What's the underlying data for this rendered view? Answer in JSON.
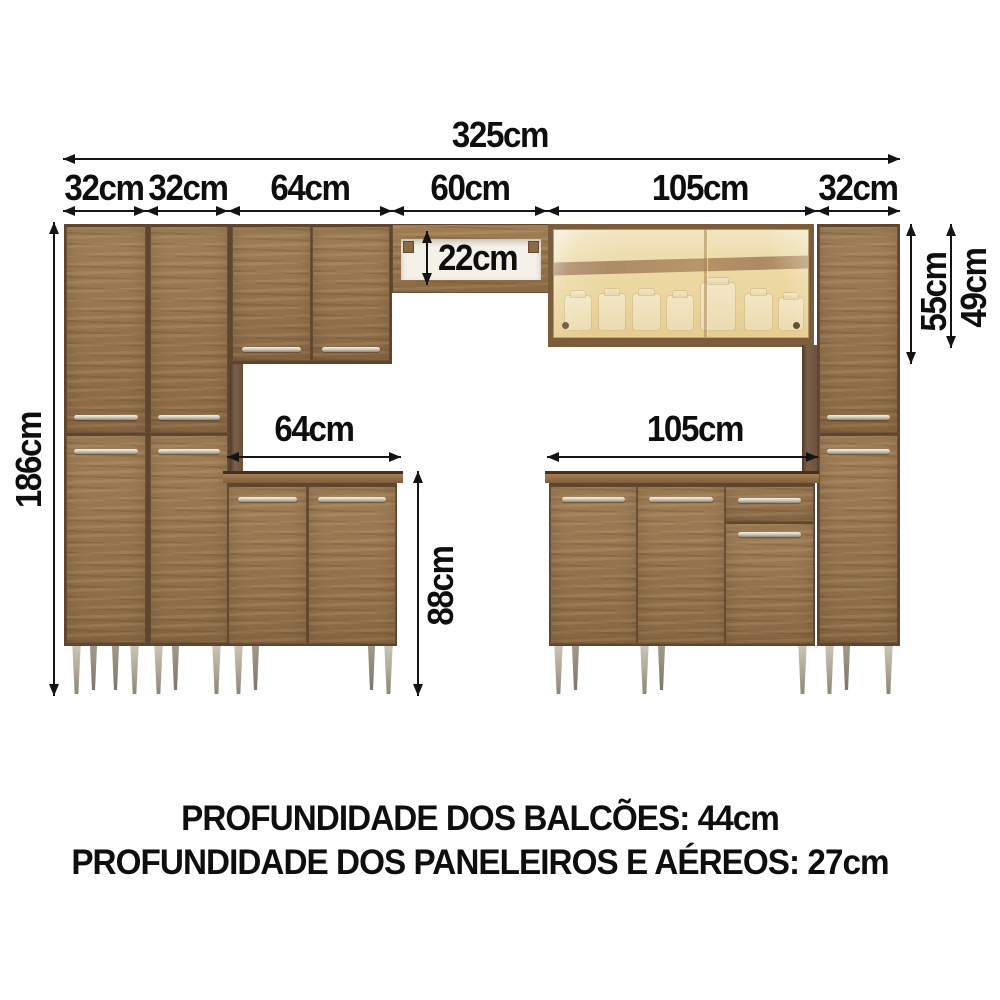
{
  "diagram": {
    "title_none": "",
    "dims": {
      "total_width": "325cm",
      "seg_widths": [
        "32cm",
        "32cm",
        "64cm",
        "60cm",
        "105cm",
        "32cm"
      ],
      "total_height": "186cm",
      "niche_height": "22cm",
      "counter_left_width": "64cm",
      "counter_right_width": "105cm",
      "counter_height": "88cm",
      "upper_section_height": "55cm",
      "aerial_cabinet_height": "49cm"
    },
    "footer": {
      "line1": "PROFUNDIDADE DOS BALCÕES: 44cm",
      "line2": "PROFUNDIDADE DOS PANELEIROS E AÉREOS: 27cm"
    },
    "colors": {
      "background": "#ffffff",
      "wood": "#96734b",
      "wood_dark": "#5e4530",
      "counter_edge": "#7f5e3c",
      "glass": "#ecd9a4",
      "glass_band": "#8a6750",
      "handle": "#d2cdbf",
      "leg": "#a8a191",
      "dimension_line": "#141414",
      "text": "#0e0e0e"
    }
  }
}
